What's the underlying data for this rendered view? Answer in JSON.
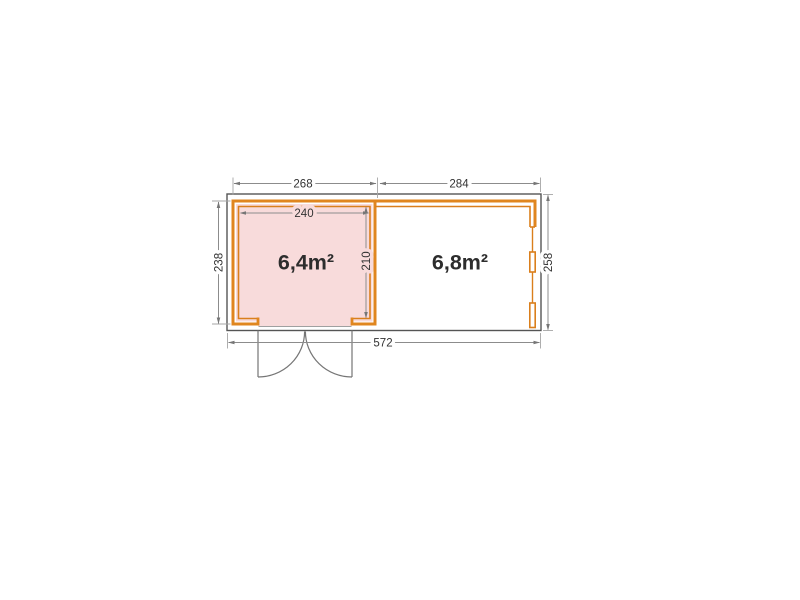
{
  "page": {
    "background": "#ffffff"
  },
  "colors": {
    "wall_orange": "#e0861f",
    "wall_orange_thin": "#da7f1c",
    "room_pink": "#f8dbdb",
    "outline_gray": "#555555",
    "dim_line": "#8c8c8c",
    "text_dark": "#333333",
    "area_text": "#2d2d2d"
  },
  "floor_plan": {
    "type": "floor-plan",
    "rooms": [
      {
        "id": "left-room",
        "area": "6,4m²"
      },
      {
        "id": "right-room",
        "area": "6,8m²"
      }
    ],
    "dimensions": {
      "w_left": "268",
      "w_right": "284",
      "w_inner": "240",
      "d_left": "238",
      "d_inner": "210",
      "d_right": "258",
      "w_total": "572"
    }
  }
}
